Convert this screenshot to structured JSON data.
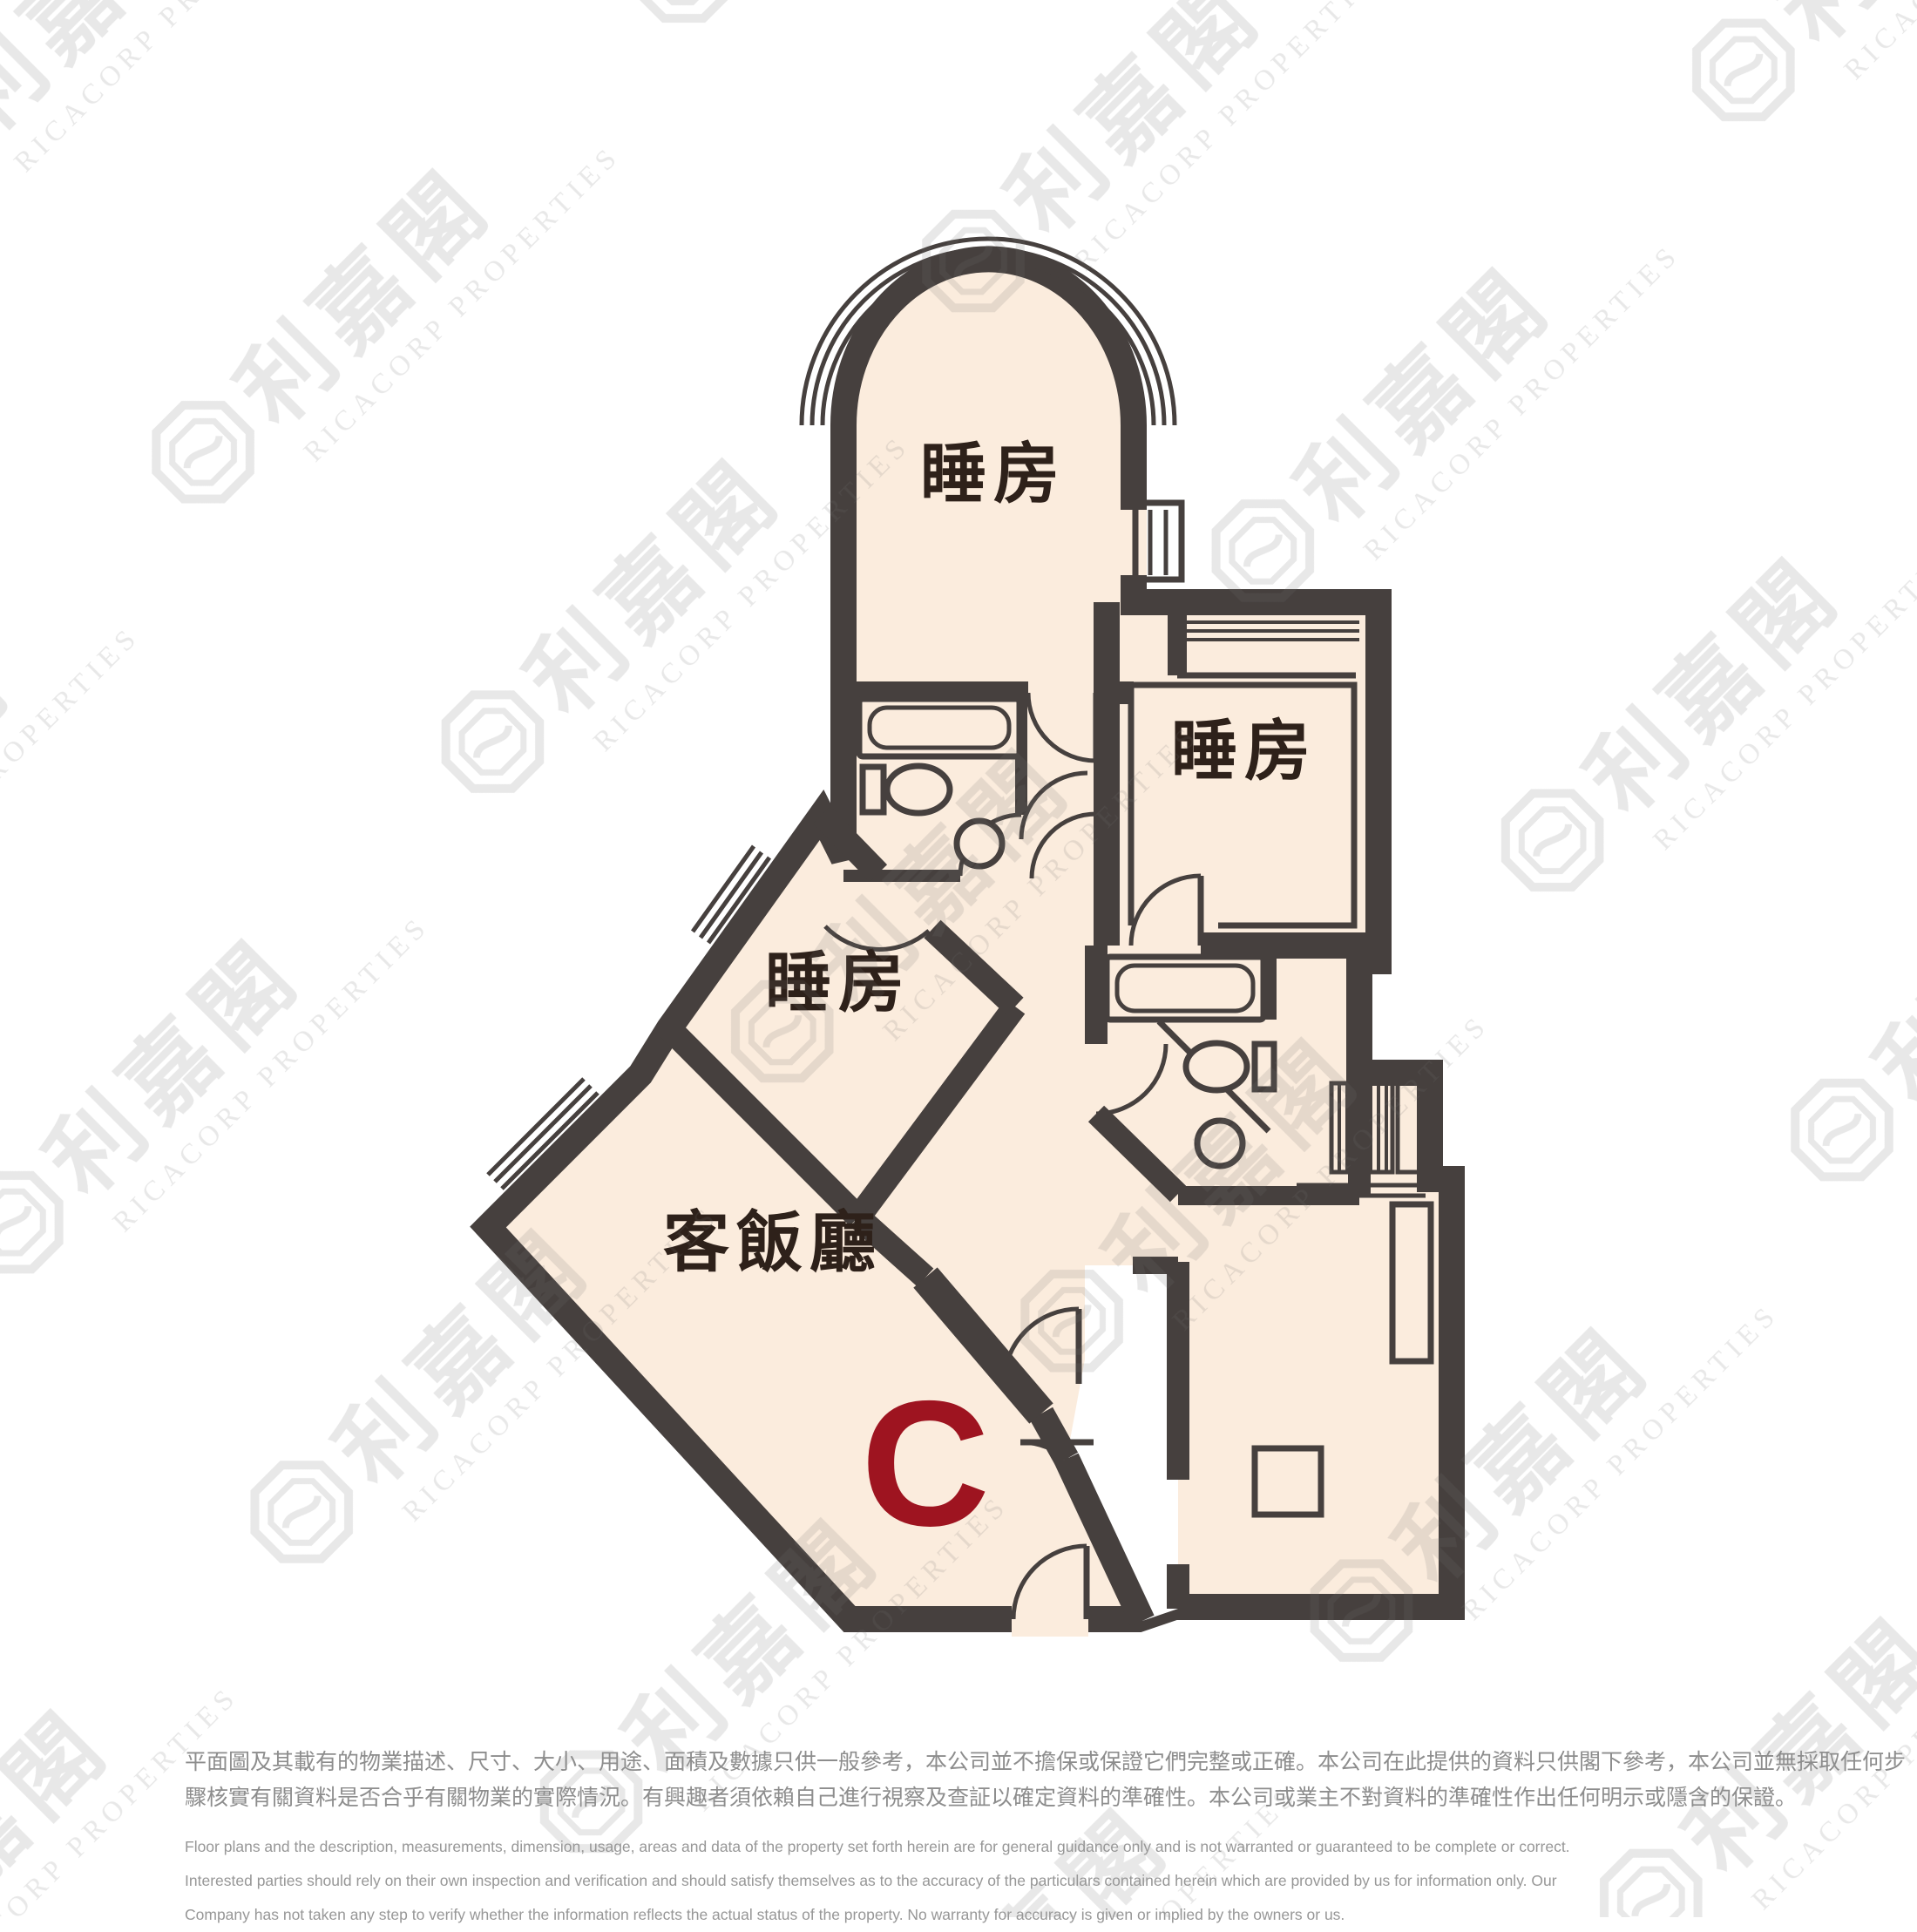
{
  "watermark": {
    "brand_zh": "利嘉閣",
    "brand_en": "RICACORP PROPERTIES"
  },
  "floor_plan": {
    "unit_label": "C",
    "rooms": {
      "bedroom1": "睡房",
      "bedroom2": "睡房",
      "bedroom3": "睡房",
      "living_dining": "客飯廳"
    },
    "colors": {
      "wall": "#46403e",
      "room_fill": "#fbecdd",
      "room_label": "#2e211a",
      "unit_label": "#9e1420",
      "watermark_gray": "#ededed"
    }
  },
  "disclaimer": {
    "zh_line1": "平面圖及其載有的物業描述、尺寸、大小、用途、面積及數據只供一般參考，本公司並不擔保或保證它們完整或正確。本公司在此提供的資料只供閣下參考，本公司並無採取任何步",
    "zh_line2": "驟核實有關資料是否合乎有關物業的實際情況。有興趣者須依賴自己進行視察及查証以確定資料的準確性。本公司或業主不對資料的準確性作出任何明示或隱含的保證。",
    "en_line1": "Floor plans and the description, measurements, dimension, usage, areas and data of the property set forth herein are for general guidance only and is not warranted or guaranteed to be complete or correct.",
    "en_line2": "Interested parties should rely on their own inspection and verification and should satisfy themselves as to the accuracy of the particulars contained herein which are provided by us for information only.  Our",
    "en_line3": "Company has not taken any step to verify whether the information reflects the actual status of the property.  No warranty for accuracy is given or implied by the owners or us."
  }
}
